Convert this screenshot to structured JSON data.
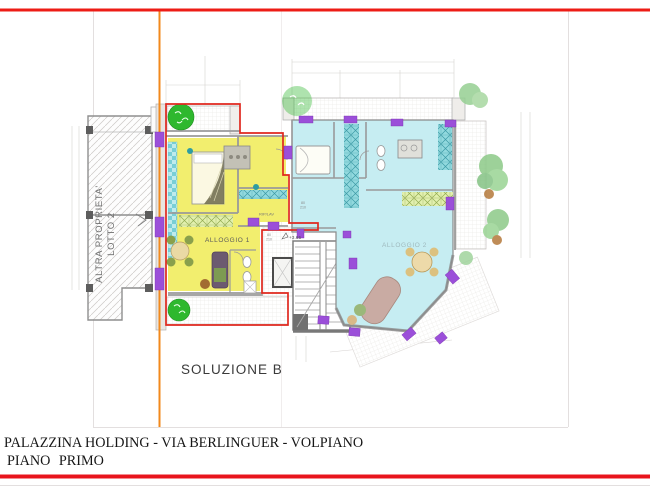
{
  "page": {
    "background": "#ffffff"
  },
  "frame": {
    "top_line_color": "#ed1c16",
    "bottom_line_color": "#e8141c",
    "property_line_color": "#f2891c",
    "border_color": "#e3dfdf"
  },
  "title_block": {
    "line1": "PALAZZINA HOLDING - VIA BERLINGUER - VOLPIANO",
    "line2": "PIANO PRIMO"
  },
  "plan": {
    "solution_label": "SOLUZIONE B",
    "apartment1_label": "ALLOGGIO 1",
    "apartment2_label": "ALLOGGIO 2",
    "neighbor_line1": "ALTRA PROPRIETA'",
    "neighbor_line2": "LOTTO 2",
    "storage_label": "RIP/LAV",
    "elevation_label": "+3.65",
    "door_width": "80",
    "door_height": "210",
    "colors": {
      "apartment1_fill": "#f2ee6e",
      "apartment2_fill": "#c6edf2",
      "apartment1_outline": "#e0281e",
      "window_marker": "#9b4fd9",
      "tree_green": "#2eb82e",
      "wall_gray": "#9a9a9a"
    }
  }
}
